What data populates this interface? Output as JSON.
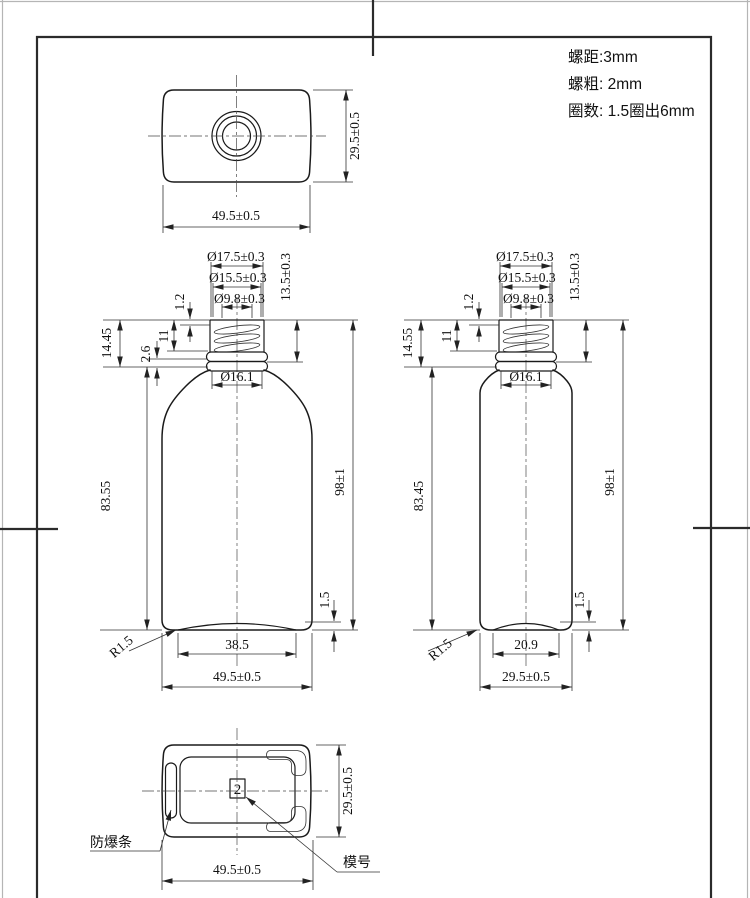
{
  "notes": {
    "lines": [
      "螺距:3mm",
      "螺粗: 2mm",
      "圈数: 1.5圈出6mm"
    ]
  },
  "cap_top_view": {
    "width": "49.5±0.5",
    "height": "29.5±0.5"
  },
  "bottle_oval": {
    "thread_od": "Ø17.5±0.3",
    "neck_od": "Ø15.5±0.3",
    "opening_id": "Ø9.8±0.3",
    "neck_height": "13.5±0.3",
    "thread_start": "1.2",
    "thread_section": "11",
    "ring_section": "2.6",
    "finish_height": "14.45",
    "neck_base_od": "Ø16.1",
    "body_height": "83.55",
    "overall_height": "98±1",
    "base_pushup": "1.5",
    "base_corner_radius": "R1.5",
    "base_flat_width": "38.5",
    "overall_width": "49.5±0.5"
  },
  "bottle_round": {
    "thread_od": "Ø17.5±0.3",
    "neck_od": "Ø15.5±0.3",
    "opening_id": "Ø9.8±0.3",
    "neck_height": "13.5±0.3",
    "thread_start": "1.2",
    "thread_section": "11",
    "finish_height": "14.55",
    "neck_base_od": "Ø16.1",
    "body_height": "83.45",
    "overall_height": "98±1",
    "base_pushup": "1.5",
    "base_corner_radius": "R1.5",
    "base_flat_width": "20.9",
    "overall_width": "29.5±0.5"
  },
  "cap_bottom_view": {
    "width": "49.5±0.5",
    "height": "29.5±0.5",
    "mold_number": "2",
    "antiburst_label": "防爆条",
    "mold_label": "模号"
  }
}
